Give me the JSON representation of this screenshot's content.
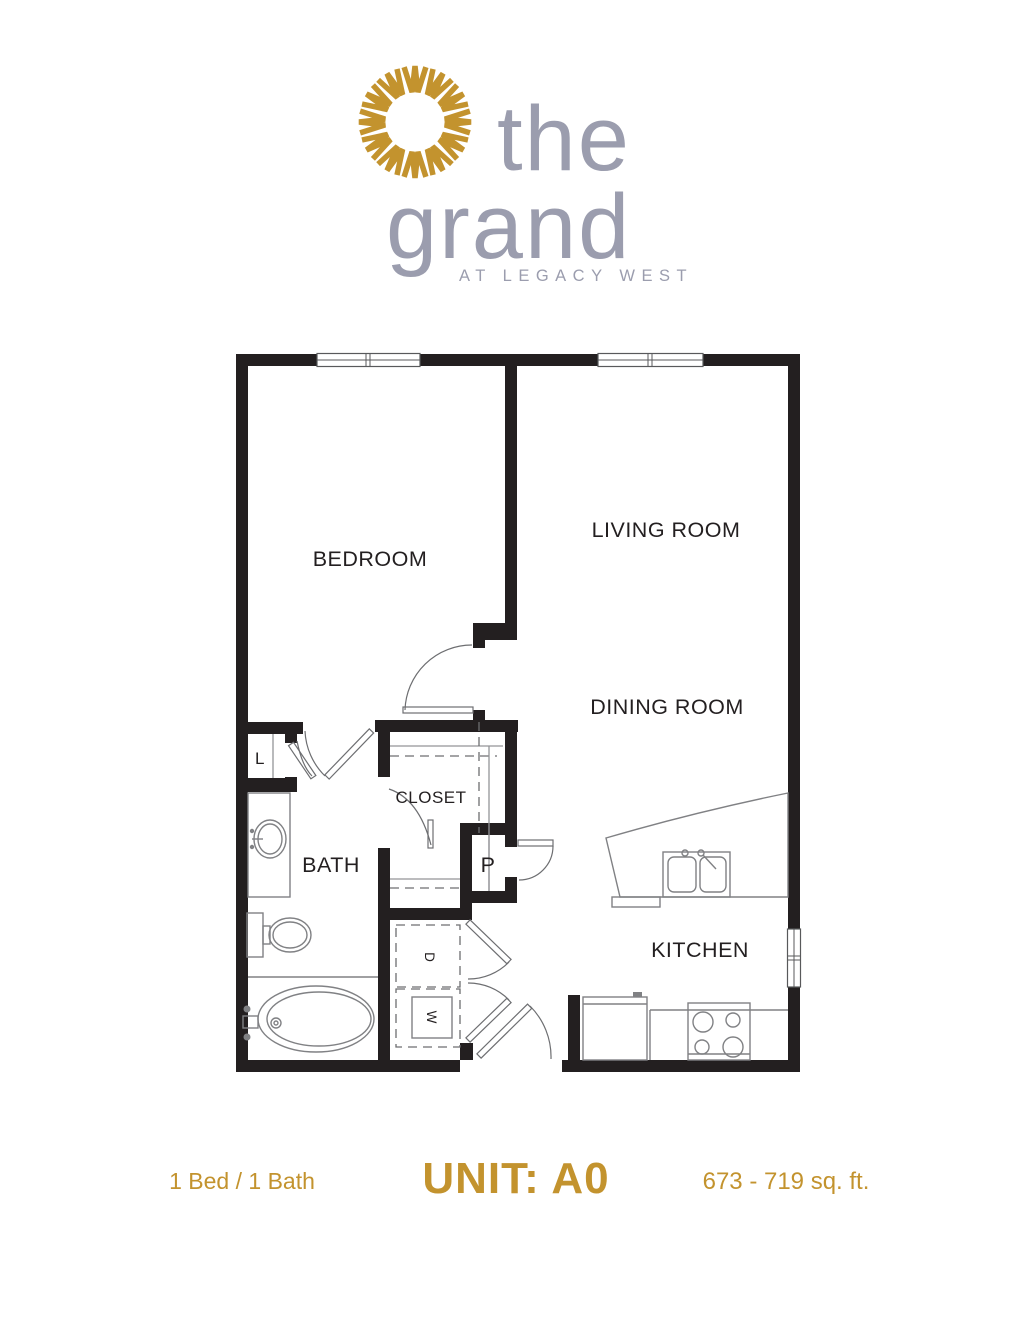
{
  "colors": {
    "gold": "#C3932E",
    "logo_gray": "#9B9DAE",
    "wall": "#231F20"
  },
  "logo": {
    "icon": "sunburst",
    "word_top": "the",
    "word_main": "grand",
    "tagline": "AT LEGACY WEST"
  },
  "plan": {
    "labels": {
      "bedroom": "BEDROOM",
      "living_room": "LIVING ROOM",
      "dining_room": "DINING ROOM",
      "kitchen": "KITCHEN",
      "bath": "BATH",
      "closet": "CLOSET",
      "linen": "L",
      "pantry": "P",
      "dryer": "D",
      "washer": "W"
    }
  },
  "footer": {
    "config": "1 Bed / 1 Bath",
    "unit": "UNIT: A0",
    "area": "673 - 719 sq. ft."
  }
}
